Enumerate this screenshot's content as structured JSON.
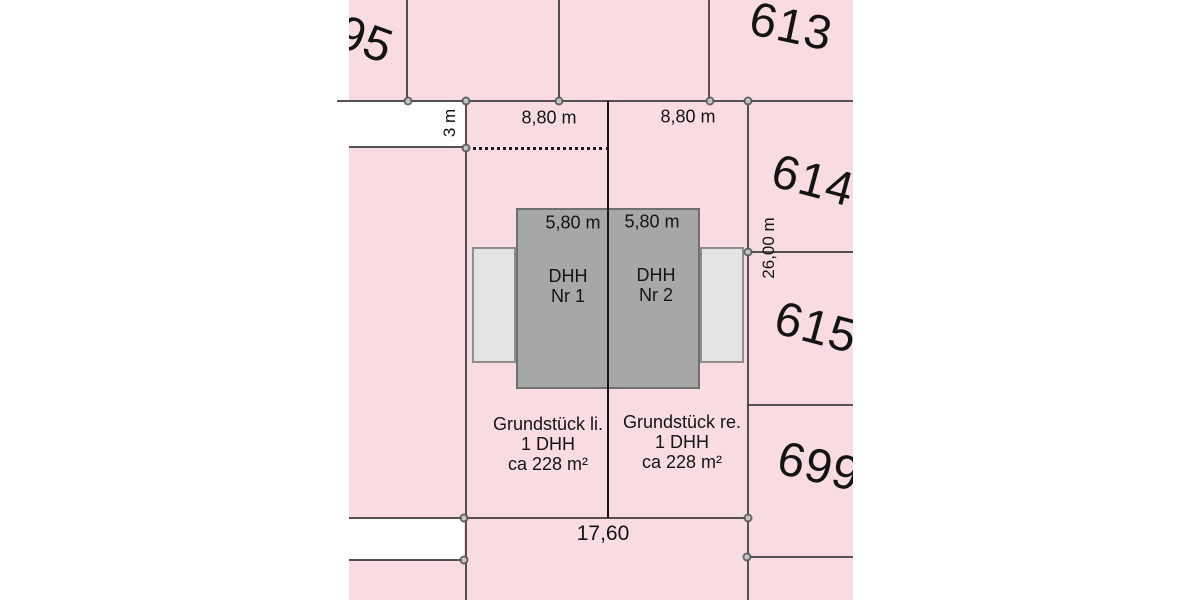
{
  "colors": {
    "background": "#ffffff",
    "parcel_fill": "#f8dce1",
    "house_fill": "#a7a7a7",
    "house_border": "#6f6f6f",
    "garage_fill": "#e3e3e3",
    "garage_border": "#8e8e8e",
    "boundary_line": "#3c3c3c",
    "split_line": "#151515",
    "node_fill": "#cfcfcf",
    "node_border": "#5a5a5a",
    "text": "#141414"
  },
  "parcel_numbers": {
    "top_left": "95",
    "p613": "613",
    "p614": "614",
    "p615": "615",
    "p699": "699"
  },
  "dimensions": {
    "top_width_left": "8,80 m",
    "top_width_right": "8,80 m",
    "offset_depth": "3 m",
    "side_depth": "26,00 m",
    "house_width_left": "5,80 m",
    "house_width_right": "5,80 m",
    "bottom_width": "17,60"
  },
  "buildings": {
    "house_left": "DHH\nNr 1",
    "house_right": "DHH\nNr 2"
  },
  "plots": {
    "left": "Grundstück li.\n1 DHH\nca 228 m²",
    "right": "Grundstück re.\n1 DHH\nca 228 m²"
  }
}
